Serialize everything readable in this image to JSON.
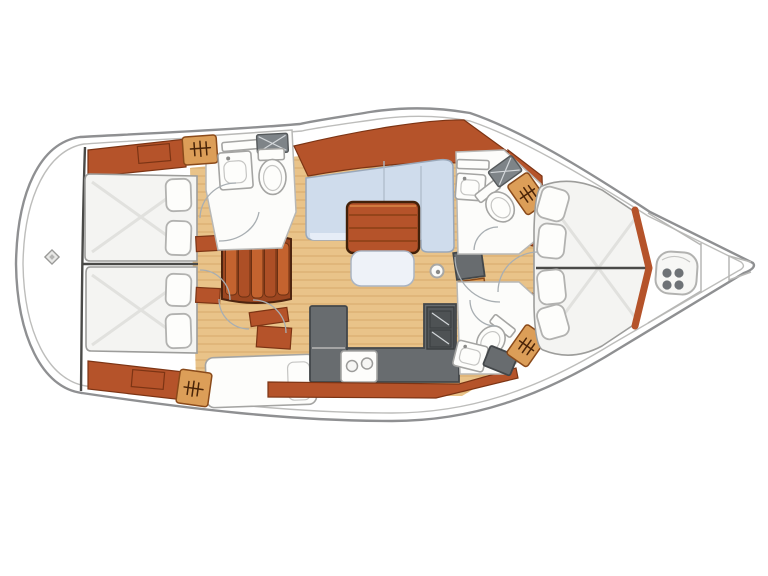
{
  "figure": {
    "kind": "sailing-yacht interior floor plan",
    "view": "top-down plan drawing, no text labels",
    "bow": "right",
    "stern": "left"
  },
  "colors": {
    "bg": "#ffffff",
    "outline": "#8f9092",
    "outline_light": "#bdbdbb",
    "divider": "#4a4a48",
    "wood": "#b5532a",
    "wood_dark": "#7c3414",
    "wood_light": "#cd6e38",
    "locker": "#dc9e58",
    "locker_dark": "#8a4a1a",
    "locker_icon": "#4a2408",
    "floor": "#e9c389",
    "plank": "#d6a96b",
    "mattress": "#f4f4f2",
    "mattress_line": "#dddddb",
    "fixture": "#fcfcfa",
    "fixture_stroke": "#a5a5a3",
    "cushion": "#cfdcec",
    "cushion_light": "#e6edf7",
    "cushion_stroke": "#9aa8ba",
    "counter": "#686c6f",
    "counter_dark": "#43474a",
    "stove": "#53575a",
    "hatch": "#7e8488",
    "arc": "#a8aeb2"
  },
  "rooms": [
    {
      "name": "stern-platform",
      "fixtures": [
        "stern-fitting"
      ]
    },
    {
      "name": "aft-cabin-port",
      "fixtures": [
        "double-berth",
        "two-pillows",
        "wood-shelf"
      ]
    },
    {
      "name": "aft-cabin-starboard",
      "fixtures": [
        "double-berth",
        "two-pillows",
        "wood-shelf",
        "hanging-locker",
        "desk"
      ]
    },
    {
      "name": "aft-head-port",
      "fixtures": [
        "toilet",
        "sink",
        "hatch",
        "hanging-locker",
        "shelf"
      ]
    },
    {
      "name": "salon",
      "fixtures": [
        "l-settee",
        "wood-table",
        "bench-seat",
        "mast-post"
      ]
    },
    {
      "name": "galley",
      "fixtures": [
        "l-counter",
        "double-sink",
        "stove-two-burners",
        "drawer-unit"
      ]
    },
    {
      "name": "companionway",
      "fixtures": [
        "curved-steps",
        "doors"
      ]
    },
    {
      "name": "forward-head-port",
      "fixtures": [
        "toilet",
        "sink",
        "hatch",
        "hanging-locker",
        "shelf"
      ]
    },
    {
      "name": "forward-head-starboard",
      "fixtures": [
        "toilet",
        "sink",
        "counter",
        "hanging-locker"
      ]
    },
    {
      "name": "forward-cabin",
      "fixtures": [
        "island-berth",
        "four-pillows",
        "wood-trim"
      ]
    },
    {
      "name": "forepeak",
      "fixtures": [
        "windlass",
        "anchor-locker",
        "stem-notch"
      ]
    }
  ],
  "icons": {
    "hangers": "clothes-rail-with-hooks",
    "windlass": "four-lobe-clover",
    "stern_fitting": "small-diamond",
    "hatch": "crossed-rectangle"
  }
}
